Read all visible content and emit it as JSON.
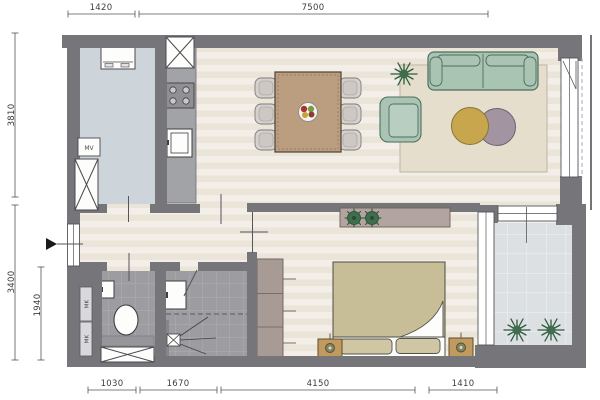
{
  "plan": {
    "dims_top": [
      "1420",
      "7500"
    ],
    "dims_left": [
      "3810",
      "3400",
      "1940"
    ],
    "dims_bottom": [
      "1030",
      "1670",
      "4150",
      "1410"
    ],
    "labels": {
      "mv": "MV",
      "mk_upper": "MK",
      "mk_lower": "MK"
    },
    "colors": {
      "wall": "#75757a",
      "floor_stripe_light": "#f3efe8",
      "floor_stripe_dark": "#eae4d9",
      "utility_floor": "#ced5da",
      "wet_room_tile": "#9d9da1",
      "balcony_floor": "#dce0e3",
      "kitchen_counter": "#a2a3a6",
      "sofa_green": "#a9c4b3",
      "rug_beige": "#e5decd",
      "wood_tan": "#bb9d80",
      "duvet_khaki": "#c7bd97",
      "cabinet_mauve": "#b2a5a1",
      "pouf_yellow": "#c8a64e",
      "pouf_purple": "#a294a0",
      "plant_green": "#3f6e4e"
    },
    "fixtures": [
      "washing-machine",
      "mechanical-ventilation-box",
      "duct-shaft",
      "kitchen-counter",
      "cooktop",
      "kitchen-sink",
      "dining-table",
      "dining-chair",
      "fruit-bowl",
      "plant",
      "sofa",
      "armchair",
      "rug",
      "pouf",
      "sideboard",
      "wardrobe",
      "bed",
      "nightstand",
      "toilet",
      "hand-basin",
      "washbasin",
      "shower-drain",
      "meter-cupboard",
      "balcony",
      "entrance-arrow"
    ]
  }
}
